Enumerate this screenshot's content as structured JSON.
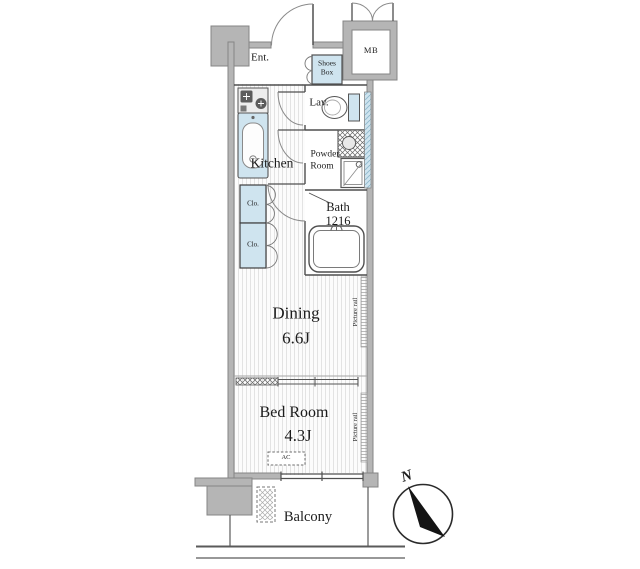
{
  "labels": {
    "entrance": "Ent.",
    "shoes_box_1": "Shoes",
    "shoes_box_2": "Box",
    "meter_box": "MB",
    "lavatory": "Lav.",
    "powder_1": "Powder",
    "powder_2": "Room",
    "bath": "Bath",
    "bath_size": "1216",
    "kitchen": "Kitchen",
    "closet_1": "Clo.",
    "closet_2": "Clo.",
    "dining": "Dining",
    "dining_size": "6.6J",
    "bedroom": "Bed Room",
    "bedroom_size": "4.3J",
    "picture_rail_dining": "Picture rail",
    "picture_rail_bedroom": "Picture rail",
    "ac": "AC",
    "balcony": "Balcony",
    "north": "N"
  },
  "colors": {
    "wall_fill": "#b5b5b5",
    "wall_edge": "#858585",
    "fixture_blue": "#cfe4ef",
    "hatch_blue": "#8fb8cc",
    "line_dark": "#4f4f4f",
    "floor_stripe": "#e3e3e3",
    "text": "#1c1c1c",
    "background": "#ffffff"
  }
}
